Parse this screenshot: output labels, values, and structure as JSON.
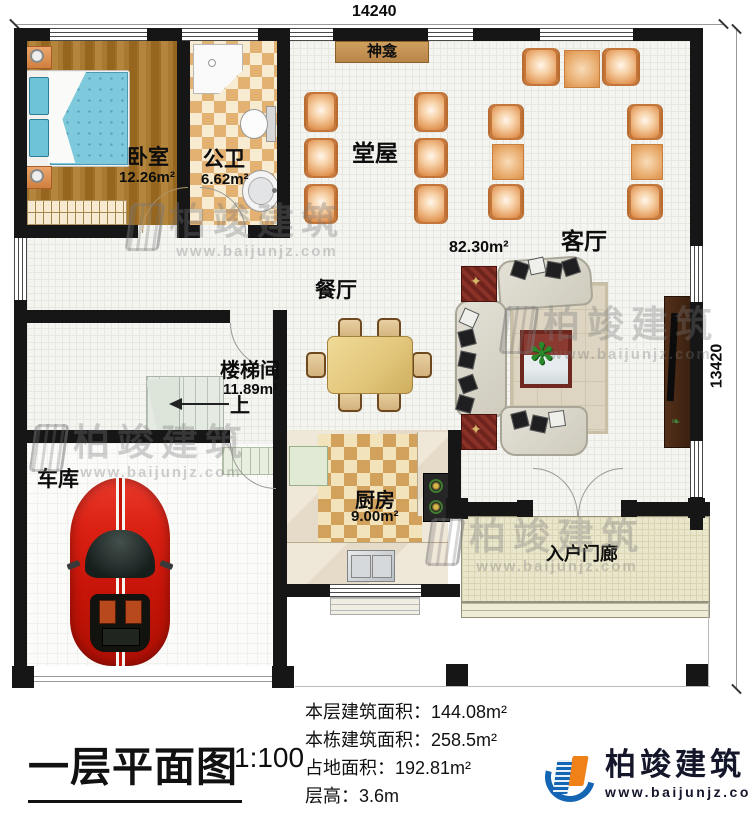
{
  "dimensions": {
    "width_label": "14240",
    "height_label": "13420"
  },
  "rooms": {
    "bedroom": {
      "label": "卧室",
      "area": "12.26m²"
    },
    "bathroom": {
      "label": "公卫",
      "area": "6.62m²"
    },
    "shrine": {
      "label": "神龛"
    },
    "hall": {
      "label": "堂屋",
      "area": "82.30m²"
    },
    "living": {
      "label": "客厅"
    },
    "dining": {
      "label": "餐厅"
    },
    "stairwell": {
      "label": "楼梯间",
      "area": "11.89m²",
      "up": "上"
    },
    "garage": {
      "label": "车库"
    },
    "kitchen": {
      "label": "厨房",
      "area": "9.00m²"
    },
    "porch": {
      "label": "入户门廊"
    }
  },
  "titleblock": {
    "title": "一层平面图",
    "scale": "1:100",
    "stats": [
      {
        "label": "本层建筑面积：",
        "value": "144.08m²"
      },
      {
        "label": "本栋建筑面积：",
        "value": "258.5m²"
      },
      {
        "label": "占地面积：",
        "value": "192.81m²"
      },
      {
        "label": "层高：",
        "value": "3.6m"
      }
    ]
  },
  "brand": {
    "name": "柏竣建筑",
    "website": "www.baijunjz.com"
  },
  "watermark": {
    "name": "柏竣建筑",
    "website": "www.baijunjz.com"
  },
  "colors": {
    "wall": "#161616",
    "brand_blue": "#1565b5",
    "brand_orange": "#f08119",
    "bed_blue": "#7ec9dc",
    "chair_orange": "#e49c5d",
    "car_red": "#d81f12"
  }
}
